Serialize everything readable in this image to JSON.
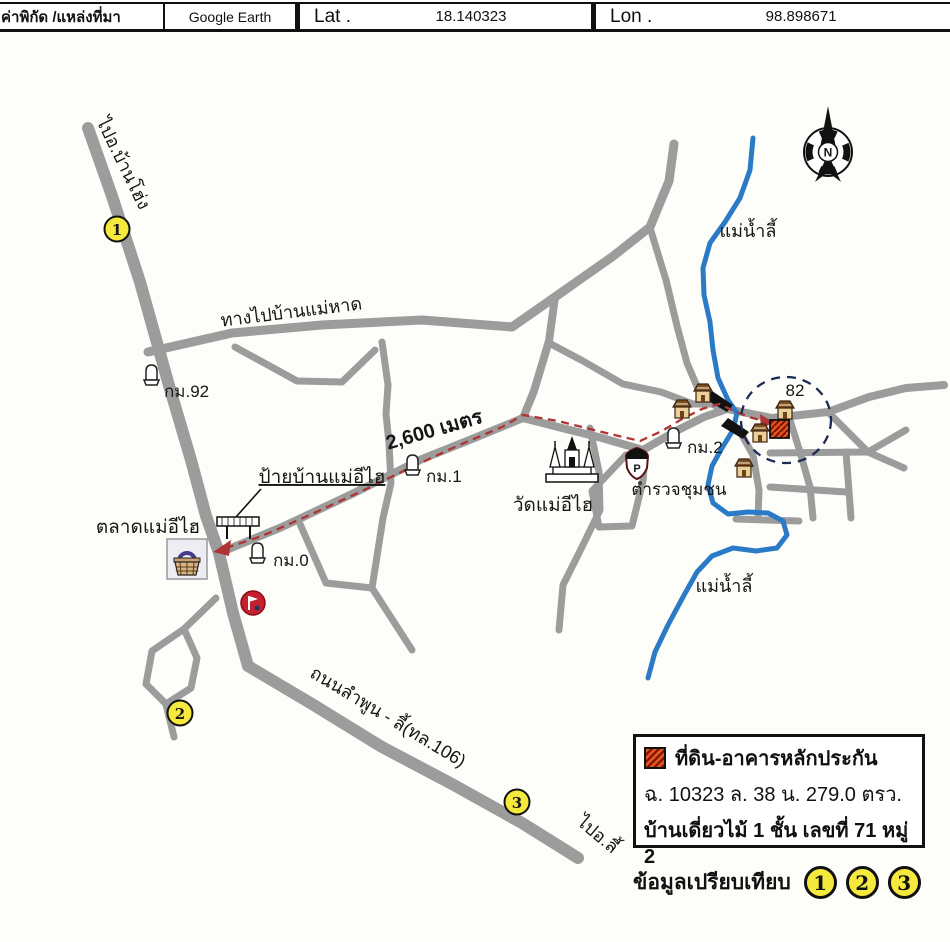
{
  "header": {
    "coord_source_label": "ค่าพิกัด /แหล่งที่มา",
    "coord_source_value": "Google Earth",
    "lat_label": "Lat .",
    "lat_value": "18.140323",
    "lon_label": "Lon .",
    "lon_value": "98.898671"
  },
  "map": {
    "compass_n": "N",
    "labels": {
      "to_ban_hong": "ไปอ.บ้านโฮ่ง",
      "to_ban_mae_hat": "ทางไปบ้านแม่หาด",
      "km92": "กม.92",
      "km1": "กม.1",
      "km0": "กม.0",
      "km2": "กม.2",
      "distance": "2,600 เมตร",
      "village_sign": "ป้ายบ้านแม่อีไฮ",
      "market": "ตลาดแม่อีไฮ",
      "temple": "วัดแม่อีไฮ",
      "police": "ตำรวจชุมชน",
      "house_no": "82",
      "river_north": "แม่น้ำลี้",
      "river_south": "แม่น้ำลี้",
      "road_lamphun_li": "ถนนลำพูน - ลี้(ทล.106)",
      "to_li": "ไปอ.ลี้",
      "police_badge_letter": "P"
    },
    "markers": {
      "m1": "1",
      "m2": "2",
      "m3": "3"
    }
  },
  "legend": {
    "title": "ที่ดิน-อาคารหลักประกัน",
    "deed_info": "ฉ. 10323 ล. 38 น. 279.0 ตรว.",
    "building_info": "บ้านเดี่ยวไม้ 1 ชั้น เลขที่ 71 หมู่ 2",
    "comparison_label": "ข้อมูลเปรียบเทียบ",
    "c1": "1",
    "c2": "2",
    "c3": "3"
  },
  "colors": {
    "road": "#9c9c9c",
    "river": "#2b7ac6",
    "route_red": "#b03434",
    "marker_yellow": "#f6e93d",
    "distance_blue": "#1c3d9e",
    "collateral_red": "#e2531f"
  }
}
